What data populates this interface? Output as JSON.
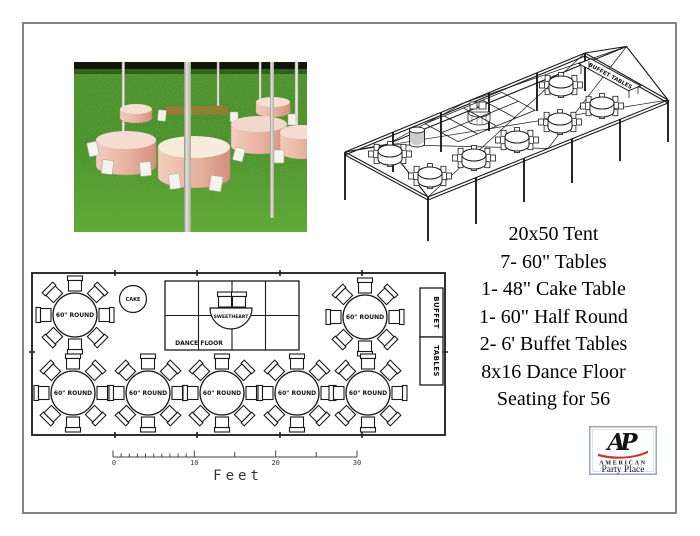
{
  "equipment_list": {
    "lines": [
      "20x50 Tent",
      "7- 60\" Tables",
      "1- 48\" Cake Table",
      "1- 60\" Half Round",
      "2- 6' Buffet Tables",
      "8x16 Dance Floor",
      "Seating for 56"
    ]
  },
  "floor_plan": {
    "round_table_label": "60\" ROUND",
    "cake_label": "CAKE",
    "sweetheart_label": "SWEETHEART",
    "dance_floor_label": "DANCE FLOOR",
    "buffet_top_label": "BUFFET",
    "buffet_bottom_label": "TABLES",
    "round_tables": [
      {
        "x": 75,
        "y": 315
      },
      {
        "x": 365,
        "y": 317
      },
      {
        "x": 73,
        "y": 393
      },
      {
        "x": 148,
        "y": 393
      },
      {
        "x": 222,
        "y": 393
      },
      {
        "x": 297,
        "y": 393
      },
      {
        "x": 368,
        "y": 393
      }
    ]
  },
  "wireframe": {
    "buffet_label": "BUFFET TABLES",
    "tables": [
      {
        "x": 52,
        "y": 114
      },
      {
        "x": 223,
        "y": 45
      },
      {
        "x": 92,
        "y": 136
      },
      {
        "x": 136,
        "y": 118
      },
      {
        "x": 179,
        "y": 100
      },
      {
        "x": 222,
        "y": 82
      },
      {
        "x": 264,
        "y": 66
      }
    ]
  },
  "scale_bar": {
    "tick_labels": [
      "0",
      "10",
      "20",
      "30"
    ],
    "unit_label": "Feet"
  },
  "logo": {
    "monogram": "AP",
    "line1": "AMERICAN",
    "line2": "Party Place",
    "red": "#c23b36",
    "blue": "#3b55a5"
  }
}
